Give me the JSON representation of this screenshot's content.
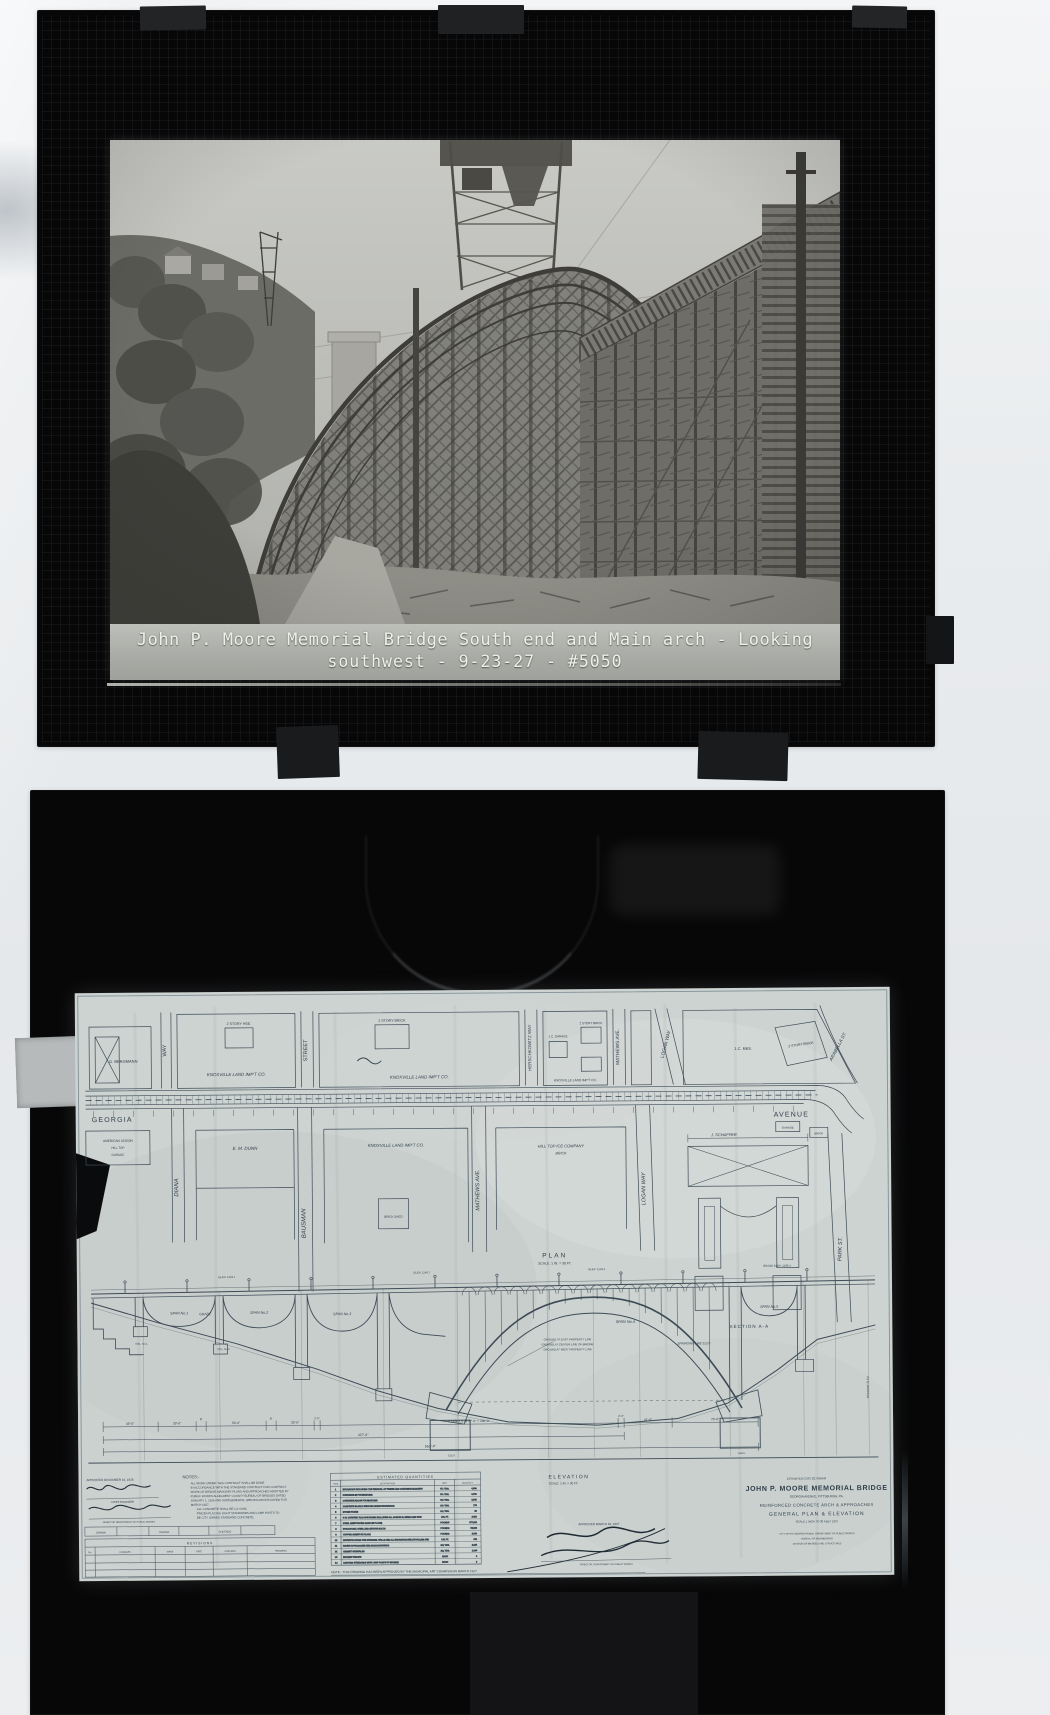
{
  "scene": {
    "background": "#e9ecee",
    "slide_frame": "#070708",
    "paper": "#ccd3d0",
    "ink": "#3d4b56",
    "caption_text": "#edefe8"
  },
  "photo_slide": {
    "caption": {
      "line1": "John P. Moore Memorial Bridge South end and Main arch - Looking",
      "line2": "southwest - 9-23-27 - #5050"
    }
  },
  "drawing_slide": {
    "plan": {
      "label": "PLAN",
      "scale": "SCALE: 1 IN. = 30 FT.",
      "georgia": "GEORGIA",
      "avenue": "AVENUE",
      "streets_upper": [
        {
          "label": "WAY"
        },
        {
          "label": "STREET"
        },
        {
          "label": "HERSCHKOWITZ WAY"
        },
        {
          "label": "MATHEWS AVE."
        },
        {
          "label": "LOGAN WAY"
        },
        {
          "label": "ARABELLA ST."
        }
      ],
      "streets_lower": [
        {
          "label": "DIANA"
        },
        {
          "label": "BAUSMAN"
        },
        {
          "label": "MATHEWS AVE."
        },
        {
          "label": "LOGAN WAY"
        },
        {
          "label": "PARK ST."
        }
      ],
      "blocks_upper": [
        {
          "label": "G. BERGMANN"
        },
        {
          "label": "2 STORY HSE."
        },
        {
          "label": "KNOXVILLE LAND IMP'T CO."
        },
        {
          "label": "2 STORY BRICK"
        },
        {
          "label": "KNOXVILLE LAND IMP'T CO."
        },
        {
          "label": "1 C. GARAGE"
        },
        {
          "label": "2 STORY BRICK"
        },
        {
          "label": "KNOXVILLE LAND IMP'T CO."
        },
        {
          "label": "1 C. RES."
        },
        {
          "label": "2 STORY BRICK"
        }
      ],
      "blocks_lower": [
        {
          "label": "AMERICAN LEGION"
        },
        {
          "label": "HILL TOP"
        },
        {
          "label": "GARAGE"
        },
        {
          "label": "E. M. DUNN"
        },
        {
          "label": "KNOXVILLE LAND IMP'T CO."
        },
        {
          "label": "BRICK SHED"
        },
        {
          "label": "HILL TOP ICE COMPANY"
        },
        {
          "label": "BRICK"
        },
        {
          "label": "J. SCHAFFER"
        },
        {
          "label": "GARAGE"
        },
        {
          "label": "BRICK"
        }
      ],
      "section_label": "SECTION A-A"
    },
    "elevation": {
      "label": "ELEVATION",
      "scale": "SCALE: 1 IN. = 30 FT.",
      "grade_label": "GRADE",
      "edge_label": "ROADWAY ELEV.",
      "spans": [
        {
          "label": "SPAN No.1"
        },
        {
          "label": "SPAN No.2"
        },
        {
          "label": "SPAN No.3"
        },
        {
          "label": "SPAN No.4"
        },
        {
          "label": "SPAN No.5"
        }
      ],
      "col_labels": [
        {
          "label": "COL. No.1"
        },
        {
          "label": "COL. No.2"
        }
      ],
      "ground_lines": [
        "GROUND AT EAST PROPERTY LINE",
        "GROUND AT CENTER LINE OF BRIDGE",
        "GROUND AT WEST PROPERTY LINE"
      ],
      "springing_label": "SPRINGING LINE ELEV.",
      "elev_marks": [
        "ELEV. 1149.7",
        "ELEV. 1146.7",
        "ELEV. 1143.4",
        "GRADE ELEV. 1139.4"
      ],
      "footing_label": "ELEV."
    },
    "dimensions": {
      "segments": [
        "46'-6\"",
        "33'-6\"",
        "8'",
        "53'-6\"",
        "8'",
        "33'-6\"",
        "2'-6\"",
        "4 PANELS @ 57'-6\" = 230'-0\"",
        "2'-6\"",
        "41'-6\"",
        "76'-6\""
      ],
      "subtotal": "427'-6\"",
      "total": "562'-4\""
    },
    "notes": {
      "heading": "NOTES:-",
      "lines": [
        "ALL WORK UNDER THIS CONTRACT SHALL BE DONE",
        "IN ACCORDANCE WITH THE STANDARD CONTRACT FOR CONTRACT",
        "WORK OF BRIDGE MASONRY PLANS AND APPROACHES ADOPTED BY",
        "PUBLIC WORKS ALLEGHENY COUNTY BUREAU OF BRIDGES DATED",
        "JANUARY 1, 1926 AND SUPPLEMENTAL SPECIFICATIONS DATED FOR",
        "MARCH 1927.",
        "ALL CONCRETE SHALL BE 1:2:4 MIX.",
        "PRICES PLACING LIGHT STANDARDS AND LAMP POSTS TO",
        "BE CITY OWNED STANDARD CONCRETE."
      ]
    },
    "quantities": {
      "title": "ESTIMATED QUANTITIES",
      "headers": [
        "ITEM",
        "DESCRIPTION",
        "UNIT",
        "QUANTITY"
      ],
      "rows": [
        [
          "1",
          "EXCAVATION INCLUDING THE REMOVAL OF TIMBER AND CONCRETE MASONRY",
          "CU. YDS.",
          "4,500"
        ],
        [
          "2",
          "CONCRETE IN FOUNDATIONS",
          "CU. YDS.",
          "1,710"
        ],
        [
          "3",
          "CONCRETE ABOVE FOUNDATIONS",
          "CU. YDS.",
          "3,048"
        ],
        [
          "4",
          "CONCRETE IN ARCH RIBS INCLUDING EXCAVATION",
          "CU. YDS.",
          "775"
        ],
        [
          "5",
          "STONE FACING",
          "CU. YDS.",
          "96"
        ],
        [
          "6",
          "6 IN. VITRIFIED TILE PIPE DRAINS INCLUDING ALL SPECIALS, BENDS AND RODS",
          "LIN. FT.",
          "2,000"
        ],
        [
          "7",
          "STEEL REINFORCING BARS (IN PLACE)",
          "POUNDS",
          "877,000"
        ],
        [
          "8",
          "STRUCTURAL STEEL AND ANCHOR BOLTS",
          "POUNDS",
          "53,000"
        ],
        [
          "9",
          "COPPER SHEETS IN PLACE",
          "POUNDS",
          "2,100"
        ],
        [
          "10",
          "WATERPROOFING THE SPANDREL WALLS AND ALL EXCAVATION BELOW FILLING AND CONNECTIONS TO EXISTING SEWERS",
          "LIN. FT.",
          "961"
        ],
        [
          "11",
          "PAVING APPROACHES AND ARCH ROADWAYS",
          "SQ. YDS.",
          "5,130"
        ],
        [
          "12",
          "CEMENT SIDEWALKS",
          "SQ. YDS.",
          "1,940"
        ],
        [
          "13",
          "BRONZE TABLETS",
          "EACH",
          "2"
        ],
        [
          "14",
          "LIGHTING STANDARDS WITH LAMP POSTS OF BRONZE",
          "EACH",
          "8"
        ]
      ]
    },
    "revisions": {
      "title": "REVISIONS",
      "headers": [
        "No.",
        "CHANGES",
        "MADE",
        "DATE",
        "CHECKED",
        "REMARKS"
      ],
      "top_row": [
        "DRAWN",
        "TRACED",
        "CHECKED"
      ]
    },
    "approvals": {
      "left_date": "APPROVED DECEMBER 16, 1926",
      "left_title1": "CHIEF ENGINEER",
      "left_title2": "DIRECTOR DEPARTMENT OF PUBLIC WORKS",
      "mid_date": "APPROVED MARCH 16, 1927",
      "mid_title": "DIRECTOR, DEPARTMENT OF PUBLIC WORKS"
    },
    "title_block": {
      "cost": "ESTIMATED COST $2,708,849",
      "title": "JOHN P. MOORE MEMORIAL BRIDGE",
      "subtitle1": "GEORGIA AVENUE, PITTSBURGH, PA.",
      "subtitle2": "REINFORCED CONCRETE ARCH & APPROACHES",
      "subtitle3": "GENERAL PLAN & ELEVATION",
      "scale_line": "SCALE 1 INCH TO 30 FEET      1927",
      "dept1": "CITY OF PITTSBURGH PENNA. DEPARTMENT OF PUBLIC WORKS",
      "dept2": "BUREAU OF ENGINEERING",
      "dept3": "DIVISION OF BRIDGES AND STRUCTURES"
    },
    "bottom_note": "NOTE:- THIS DRAWING HAS BEEN APPROVED BY THE MUNICIPAL ART COMMISSION MARCH 1927."
  }
}
